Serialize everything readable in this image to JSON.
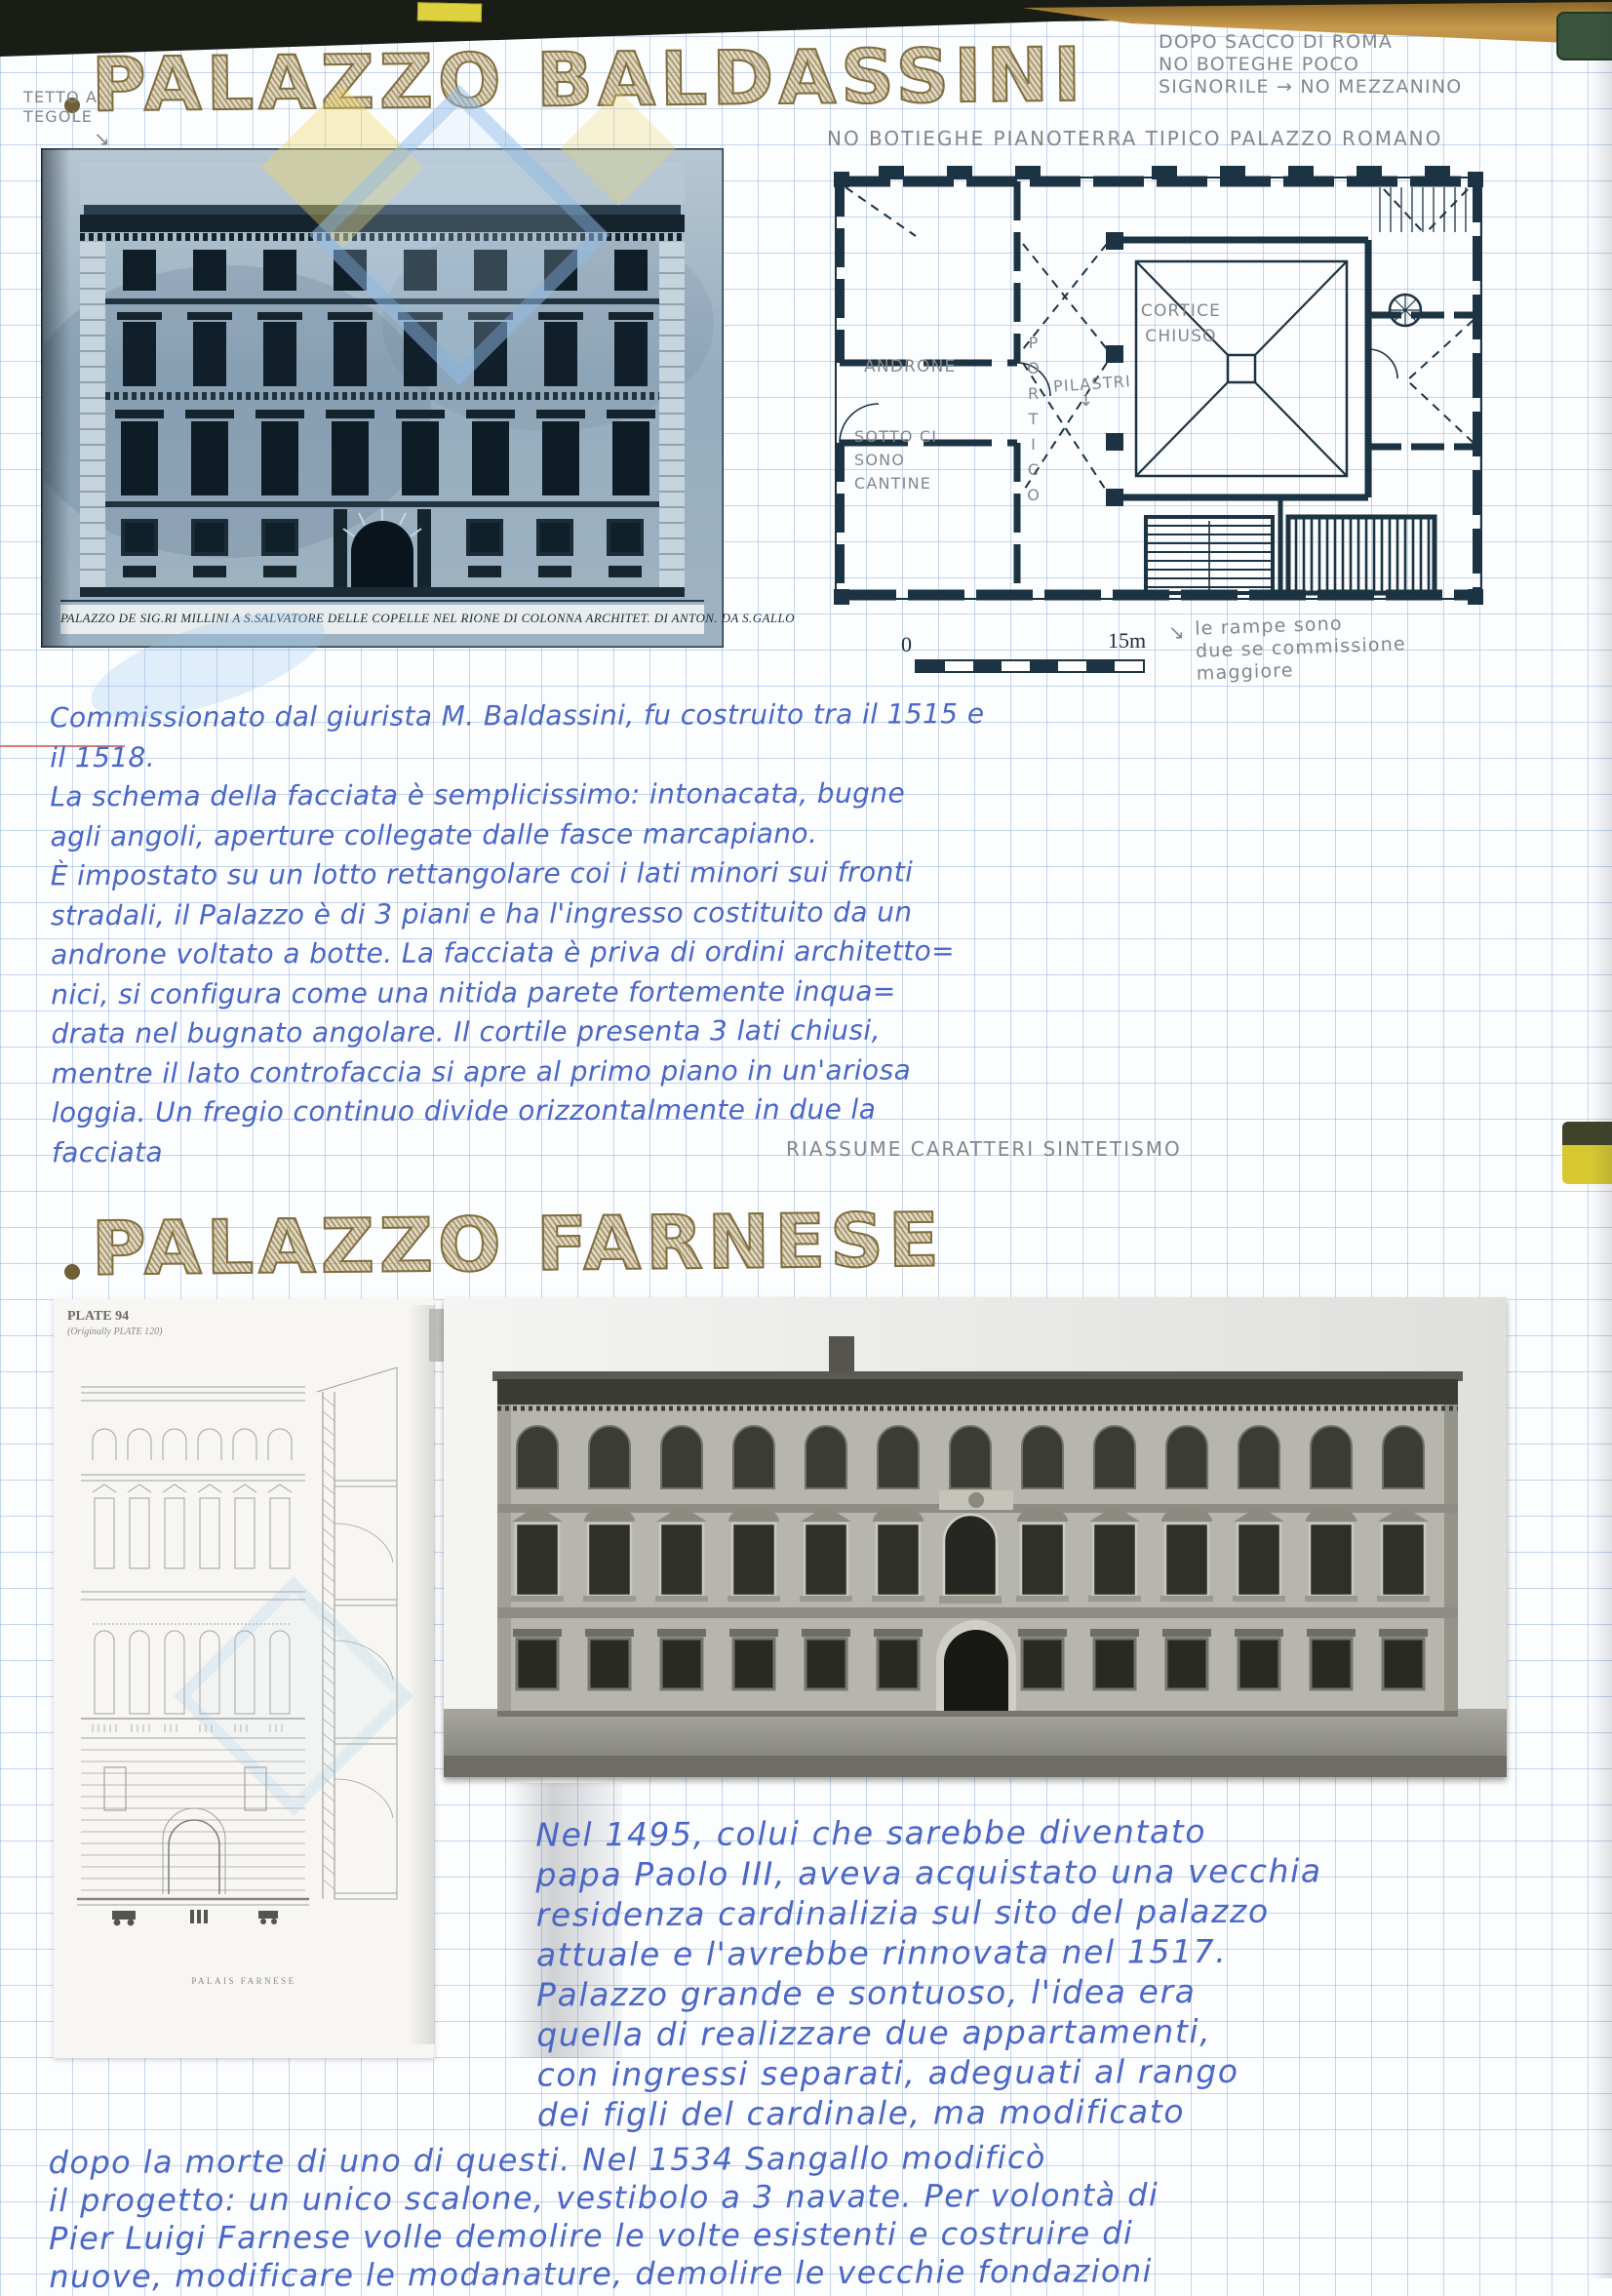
{
  "page": {
    "titles": {
      "baldassini": "PALAZZO BALDASSINI",
      "farnese": "PALAZZO FARNESE"
    },
    "colors": {
      "ink_blue": "#4a67c5",
      "pencil_gray": "#83868b",
      "title_olive": "#7f6d3e",
      "plan_navy": "#1b3342"
    },
    "baldassini": {
      "top_note_lines": [
        "DOPO SACCO DI ROMA",
        "NO BOTEGHE POCO",
        "SIGNORILE → NO MEZZANINO"
      ],
      "roof_note_lines": [
        "TETTO A",
        "TEGOLE"
      ],
      "engraving_caption": "PALAZZO DE SIG.RI MILLINI A S.SALVATORE DELLE COPELLE NEL RIONE DI COLONNA ARCHITET. DI ANTON. DA S.GALLO",
      "plan": {
        "header": "NO BOTIEGHE PIANOTERRA TIPICO PALAZZO ROMANO",
        "label_androne": "ANDRONE",
        "label_portico": "PORTICO",
        "label_pilastri": "PILASTRI",
        "pilastri_arrow": "↓",
        "label_cortile_lines": [
          "CORTICE",
          "CHIUSO"
        ],
        "label_cantine_lines": [
          "SOTTO CI",
          "SONO",
          "CANTINE"
        ],
        "scale_start": "0",
        "scale_end": "15m",
        "ramp_arrow": "↘",
        "ramp_note_lines": [
          "le rampe sono",
          "due se commissione",
          "maggiore"
        ]
      },
      "paragraph_lines": [
        "Commissionato dal giurista M. Baldassini, fu costruito tra il 1515 e",
        "il 1518.",
        "La schema della facciata è semplicissimo: intonacata, bugne",
        "agli angoli, aperture collegate dalle fasce marcapiano.",
        "È impostato su un lotto rettangolare coi i lati minori sui fronti",
        "stradali, il Palazzo è di 3 piani e ha l'ingresso costituito da un",
        "androne voltato a botte. La facciata è priva di ordini architetto=",
        "nici, si configura come una nitida parete fortemente inqua=",
        "drata nel bugnato angolare. Il cortile presenta 3 lati chiusi,",
        "mentre il lato controfaccia si apre al primo piano in un'ariosa",
        "loggia. Un fregio continuo divide orizzontalmente in due la",
        "facciata"
      ],
      "summary_note": "RIASSUME CARATTERI SINTETISMO"
    },
    "farnese": {
      "plate": {
        "header": "PLATE 94",
        "subheader": "(Originally PLATE 120)",
        "caption": "PALAIS FARNESE"
      },
      "paragraph_lines": [
        "Nel 1495, colui che sarebbe diventato",
        "papa Paolo III, aveva acquistato una vecchia",
        "residenza cardinalizia sul sito del palazzo",
        "attuale e l'avrebbe rinnovata nel 1517.",
        "Palazzo grande e sontuoso, l'idea era",
        "quella di realizzare due appartamenti,",
        "con ingressi separati, adeguati al rango",
        "dei figli del cardinale, ma modificato"
      ],
      "bottom_lines": [
        "dopo la morte di uno di questi. Nel 1534 Sangallo modificò",
        "il progetto: un unico scalone, vestibolo a 3 navate. Per volontà di",
        "Pier Luigi Farnese volle demolire le volte esistenti e costruire di",
        "nuove, modificare le modanature, demolire le vecchie fondazioni"
      ]
    }
  }
}
